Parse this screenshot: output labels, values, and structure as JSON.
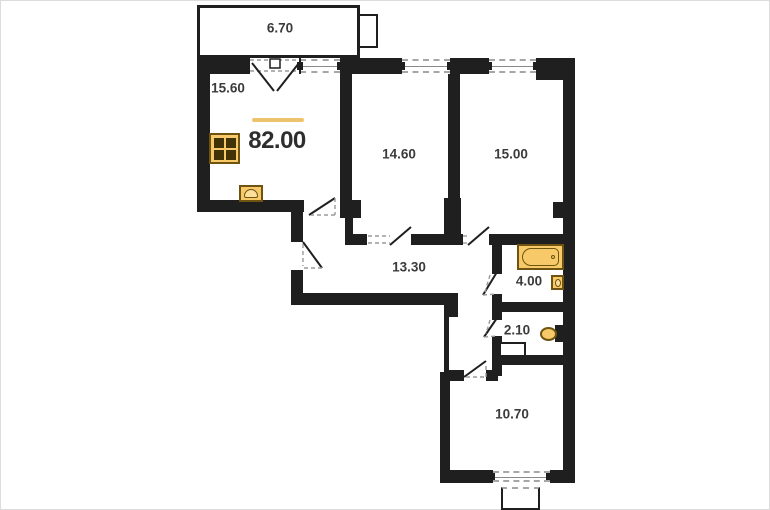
{
  "floorplan": {
    "title": "apartment floor plan",
    "total_area": "82.00",
    "rooms": [
      {
        "id": "balcony-top",
        "area": "6.70"
      },
      {
        "id": "kitchen-living",
        "area": "15.60"
      },
      {
        "id": "room-1",
        "area": "14.60"
      },
      {
        "id": "room-2",
        "area": "15.00"
      },
      {
        "id": "hallway",
        "area": "13.30"
      },
      {
        "id": "bathroom",
        "area": "4.00"
      },
      {
        "id": "wc",
        "area": "2.10"
      },
      {
        "id": "room-3",
        "area": "10.70"
      }
    ],
    "fixtures": [
      "stove-icon",
      "kitchen-sink-icon",
      "bathtub-icon",
      "wash-basin-icon",
      "toilet-icon"
    ],
    "colors": {
      "wall": "#1f1f1f",
      "fixture_fill": "#f7c968",
      "fixture_border": "#6e5410",
      "accent_line": "#eec36e",
      "text": "#3b3b3b"
    }
  }
}
